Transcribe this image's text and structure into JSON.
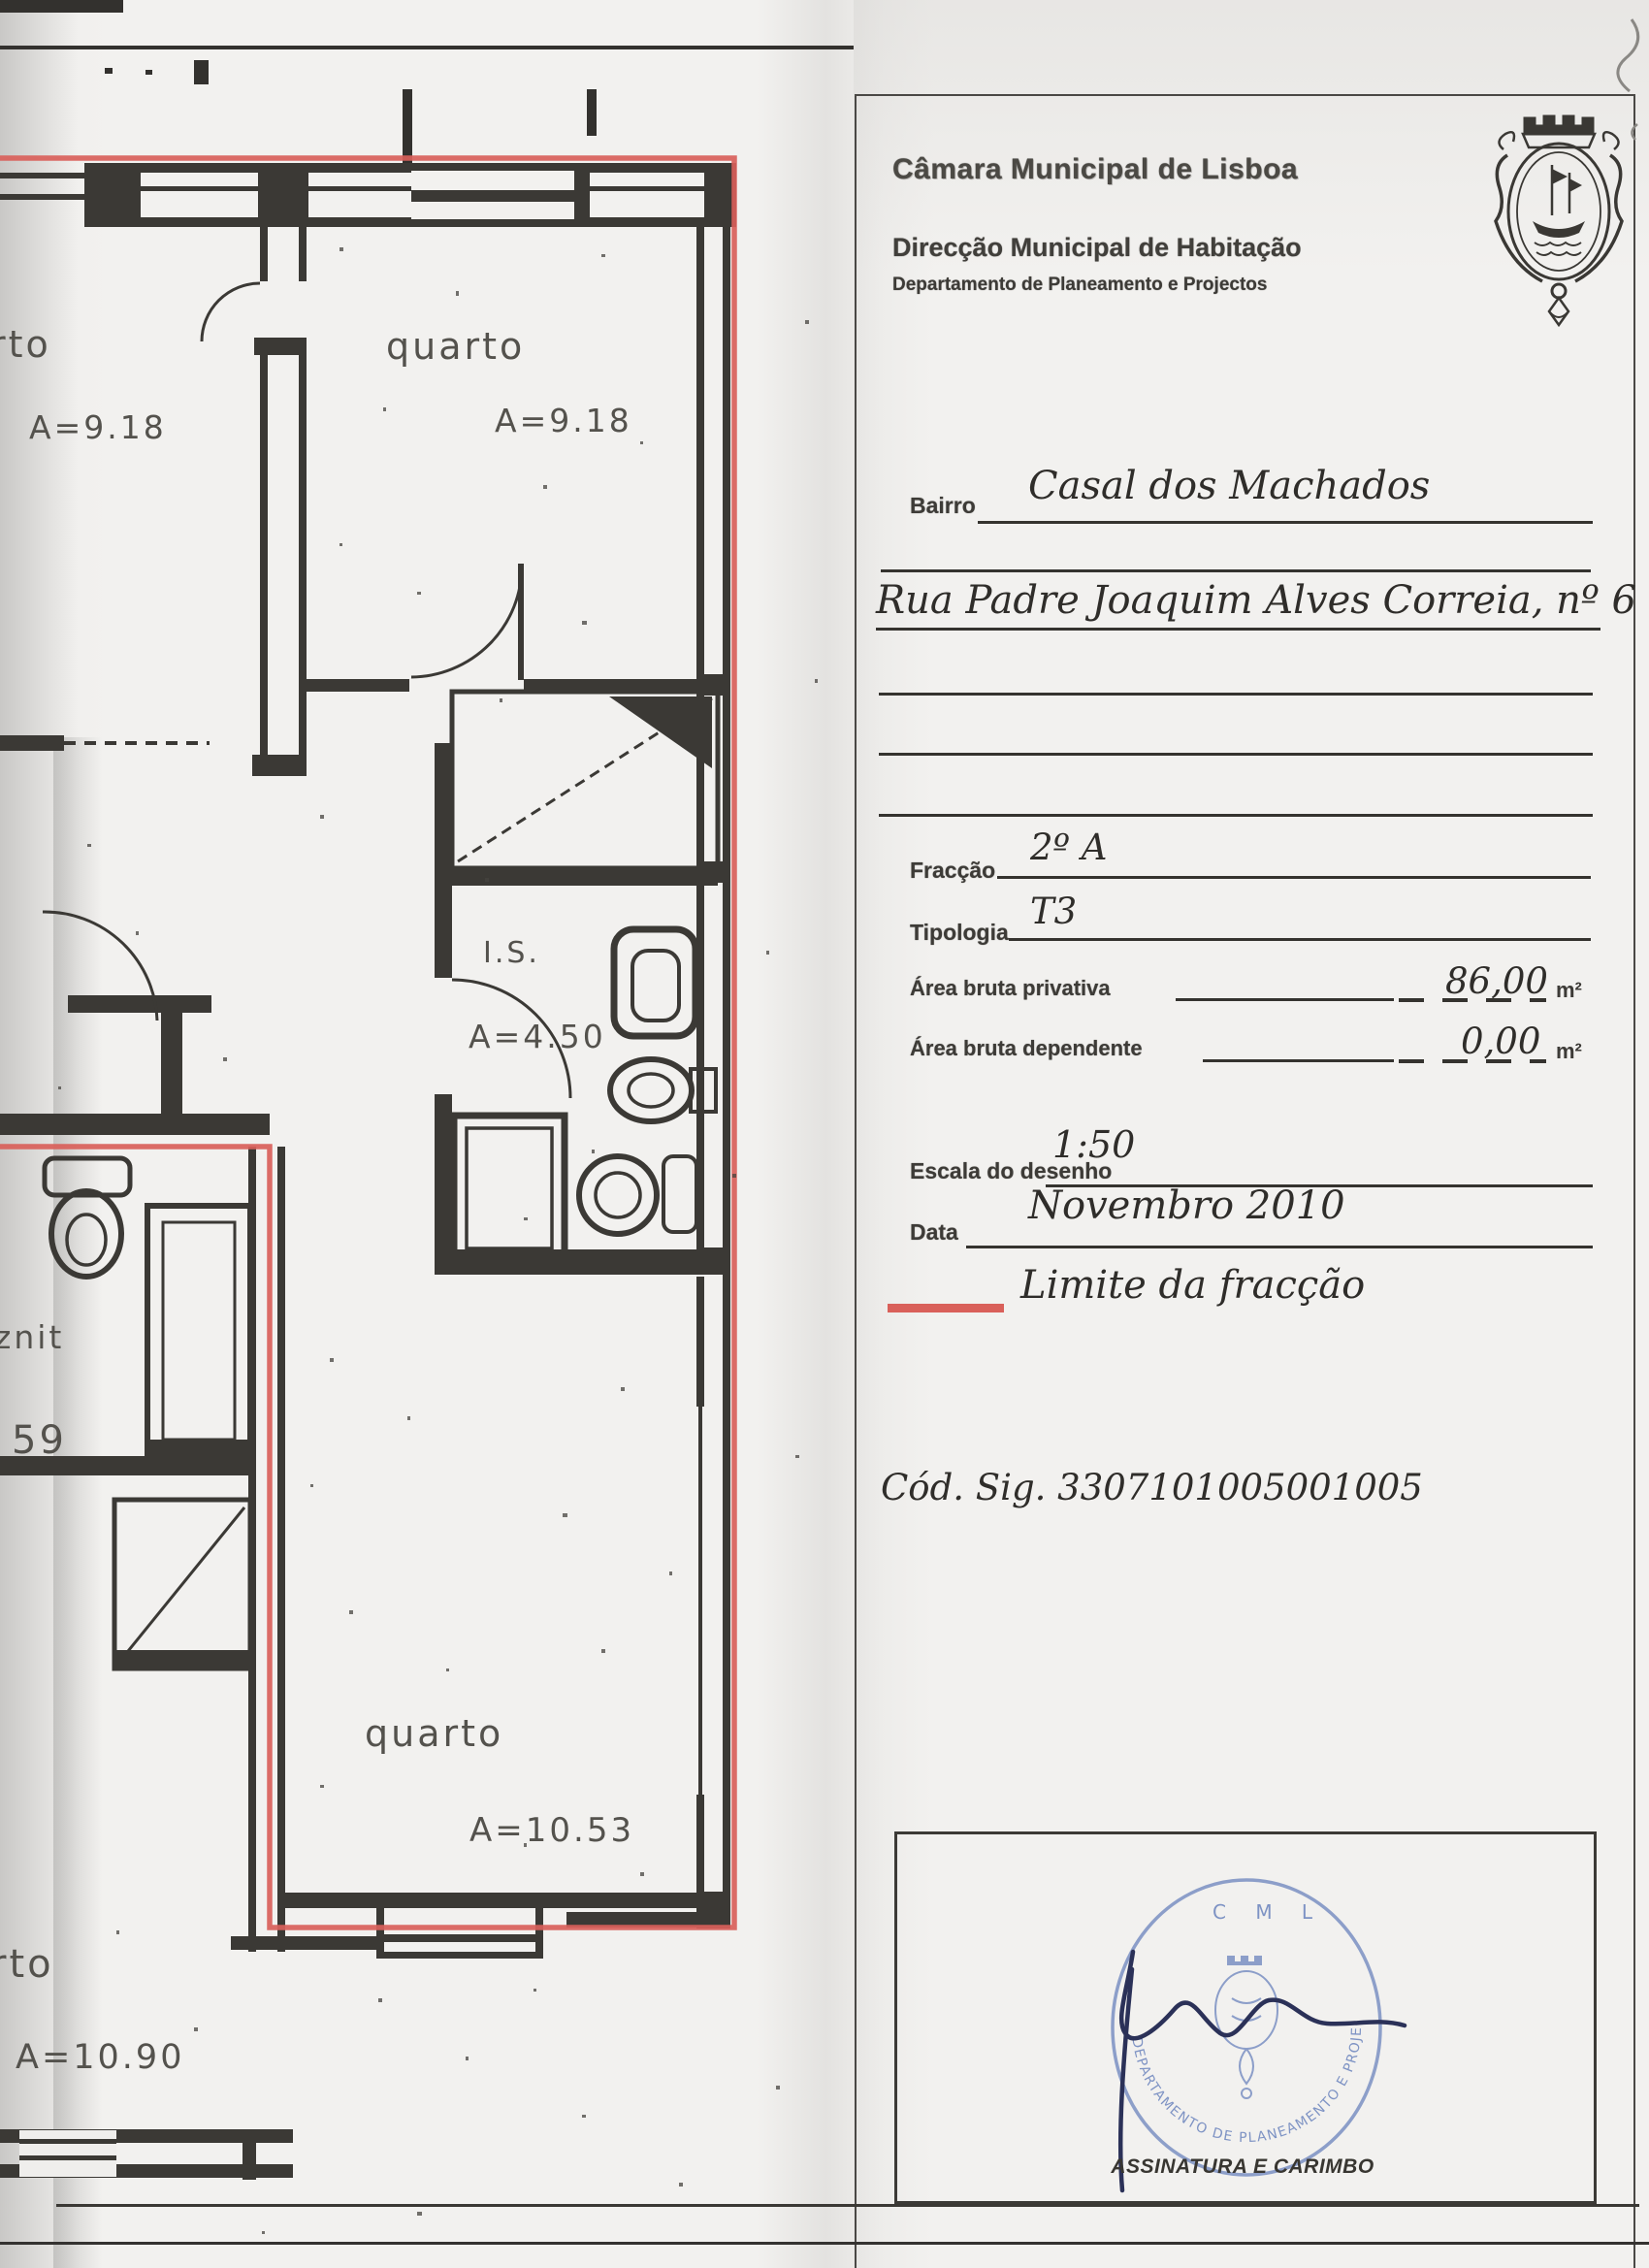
{
  "header": {
    "municipality": "Câmara Municipal de Lisboa",
    "direction": "Direcção Municipal de Habitação",
    "department": "Departamento de Planeamento e Projectos",
    "crest_icon": "lisbon-coat-of-arms"
  },
  "form": {
    "bairro_label": "Bairro",
    "bairro_value": "Casal dos Machados",
    "address_value": "Rua Padre Joaquim Alves Correia, nº 6",
    "fraccao_label": "Fracção",
    "fraccao_value": "2º A",
    "tipologia_label": "Tipologia",
    "tipologia_value": "T3",
    "area_privativa_label": "Área bruta privativa",
    "area_privativa_value": "86,00",
    "area_privativa_unit": "m²",
    "area_dependente_label": "Área bruta dependente",
    "area_dependente_value": "0,00",
    "area_dependente_unit": "m²",
    "escala_label": "Escala do desenho",
    "escala_value": "1:50",
    "data_label": "Data",
    "data_value": "Novembro 2010",
    "limite_label": "Limite da fracção",
    "cod_sig": "Cód. Sig. 3307101005001005"
  },
  "stamp": {
    "top": "C M L",
    "ring": "DEPARTAMENTO DE PLANEAMENTO E PROJECTOS",
    "caption": "ASSINATURA E CARIMBO",
    "stamp_color": "#7e93c4",
    "signature_color": "#2b3158"
  },
  "floorplan": {
    "legend_color": "#d9605a",
    "rooms": [
      {
        "name": "rto",
        "area": "A=9.18"
      },
      {
        "name": "quarto",
        "area": "A=9.18"
      },
      {
        "name": "I.S.",
        "area": "A=4.50"
      },
      {
        "name": "znit",
        "area": "59"
      },
      {
        "name": "quarto",
        "area": "A=10.53"
      },
      {
        "name": "rto",
        "area": "A=10.90"
      }
    ]
  }
}
